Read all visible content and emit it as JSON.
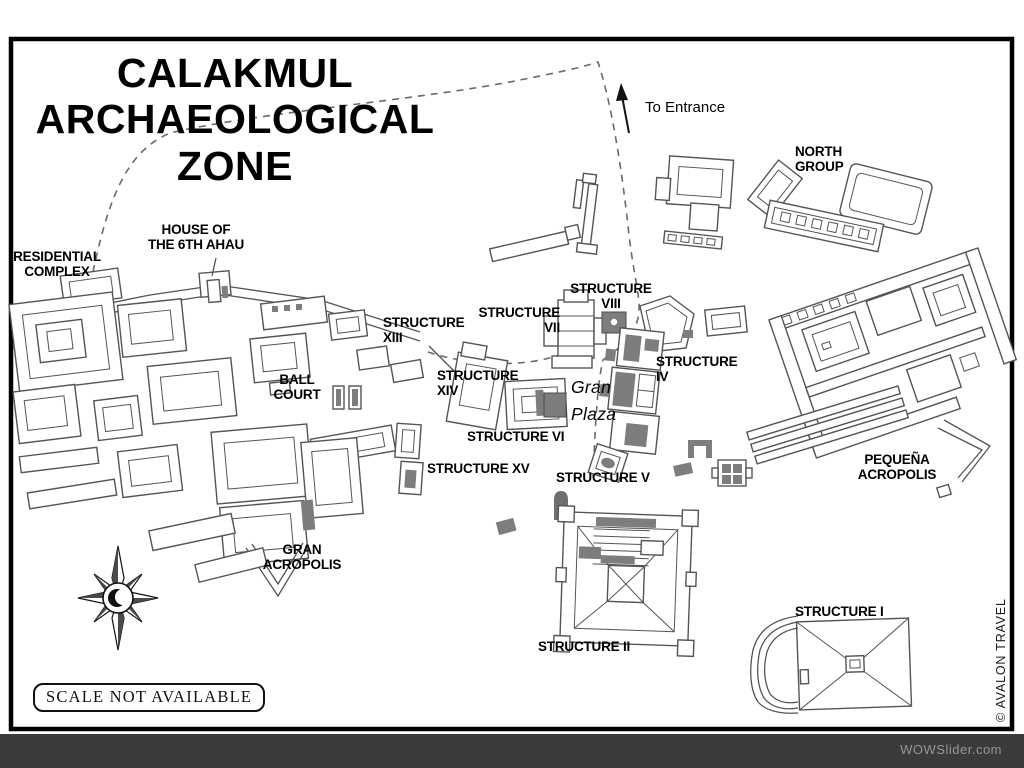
{
  "title": "CALAKMUL\nARCHAEOLOGICAL\nZONE",
  "entrance_label": "To Entrance",
  "labels": {
    "north_group": "NORTH\nGROUP",
    "residential_complex": "RESIDENTIAL\nCOMPLEX",
    "house_6th_ahau": "HOUSE OF\nTHE 6TH AHAU",
    "structure_xiii": "STRUCTURE\nXIII",
    "structure_xiv": "STRUCTURE\nXIV",
    "structure_vii": "STRUCTURE\nVII",
    "structure_viii": "STRUCTURE\nVIII",
    "structure_iv": "STRUCTURE\nIV",
    "gran_plaza": "Gran\nPlaza",
    "ball_court": "BALL\nCOURT",
    "structure_vi": "STRUCTURE VI",
    "structure_xv": "STRUCTURE XV",
    "structure_v": "STRUCTURE V",
    "gran_acropolis": "GRAN\nACROPOLIS",
    "pequena_acropolis": "PEQUEÑA\nACROPOLIS",
    "structure_ii": "STRUCTURE II",
    "structure_i": "STRUCTURE I"
  },
  "scale_note": "SCALE NOT AVAILABLE",
  "credit": "© AVALON TRAVEL",
  "footer": {
    "watermark": "WOWSlider.com"
  },
  "colors": {
    "ink": "#000000",
    "ruin_outline": "#545454",
    "ruin_fill_dark": "#7d7d7d",
    "trail": "#6a6a6a",
    "footer_bar": "#3b3b3b",
    "footer_text": "#969696"
  }
}
